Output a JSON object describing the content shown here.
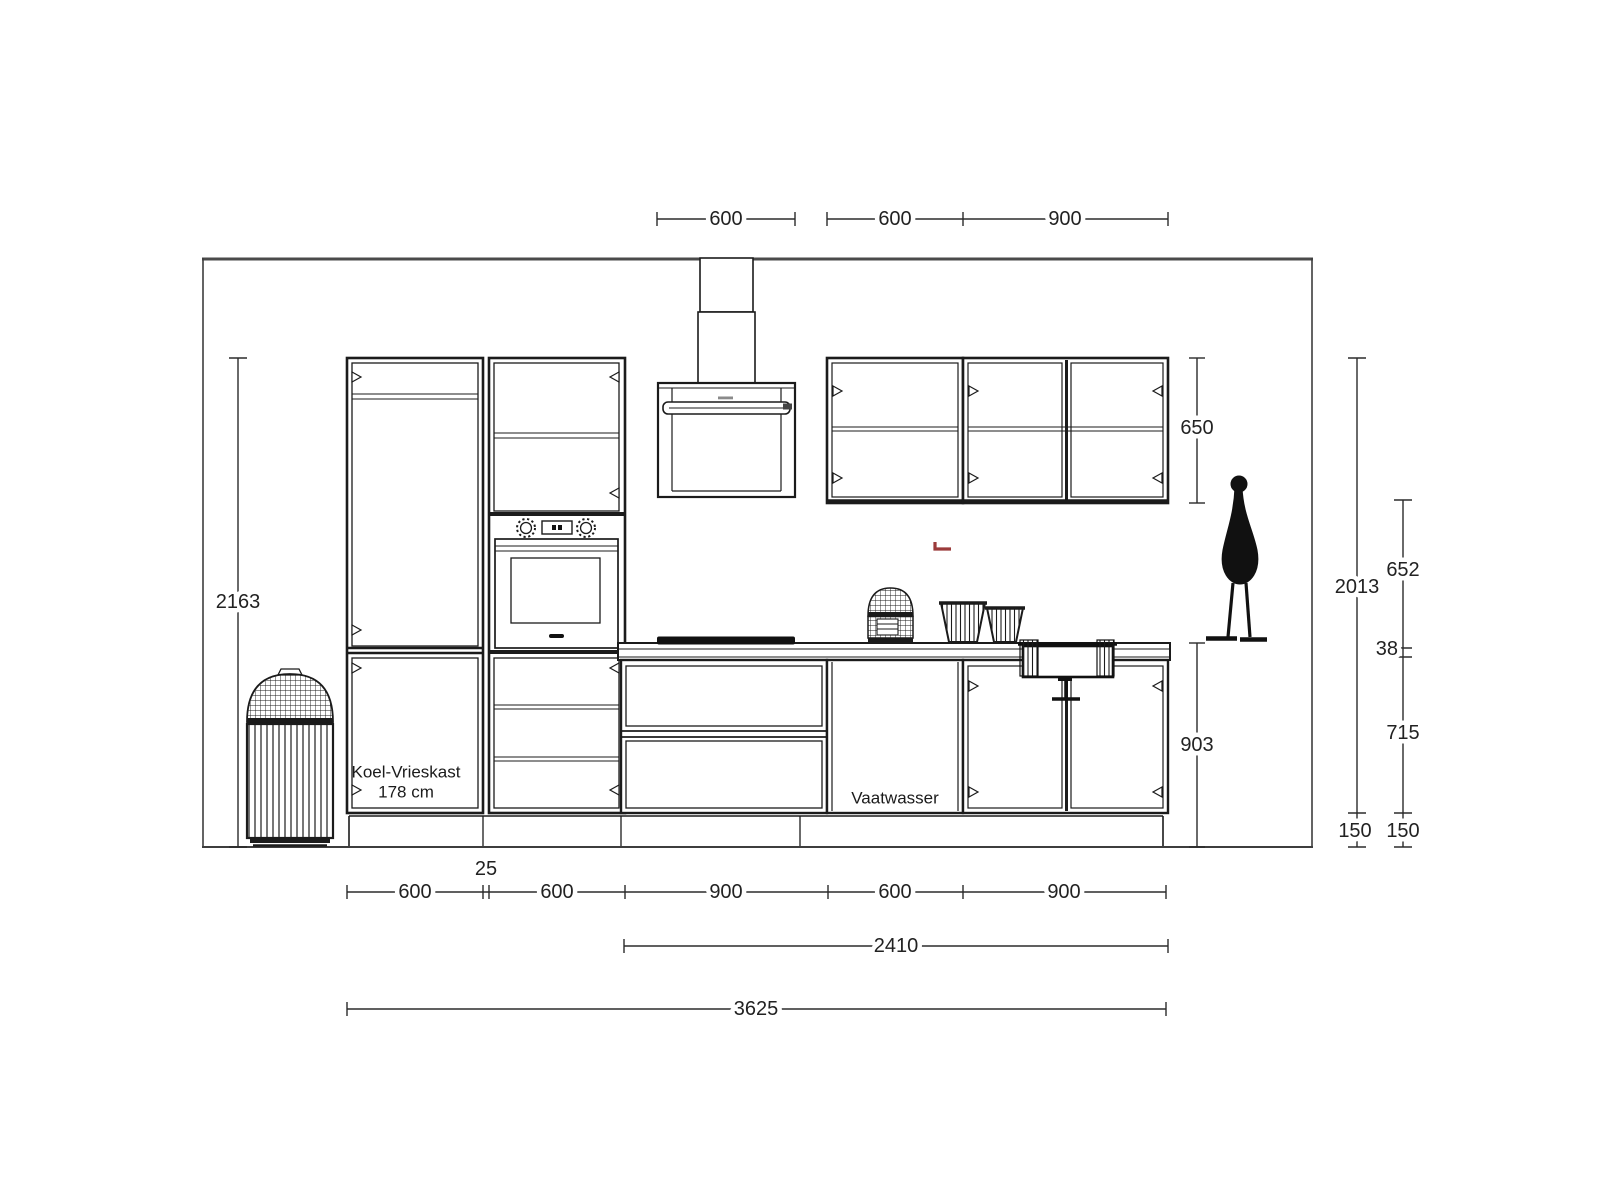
{
  "drawing": {
    "type_label": "kitchen-elevation",
    "annotations": {
      "fridge_line1": "Koel-Vrieskast",
      "fridge_line2": "178 cm",
      "dishwasher_label": "Vaatwasser"
    },
    "dimensions": {
      "top": {
        "hood_width": "600",
        "wall_cabinet_small": "600",
        "wall_cabinet_large": "900"
      },
      "left": {
        "total_height": "2163"
      },
      "right": {
        "wall_cabinet_height": "650",
        "upper_run_height": "2013",
        "splashback_height": "652",
        "worktop_thickness": "38",
        "base_front_height": "715",
        "plinth_height_a": "150",
        "plinth_height_b": "150",
        "base_total_height": "903"
      },
      "bottom": {
        "fridge_width": "600",
        "filler_width": "25",
        "oven_width": "600",
        "drawer_unit_width": "900",
        "dishwasher_width": "600",
        "sink_unit_width": "900",
        "appliance_run": "2410",
        "total_width": "3625"
      }
    },
    "colors": {
      "line": "#1b1b1b",
      "outline": "#454545",
      "dimension": "#2b2b2b",
      "accent_red": "#9b3a3a",
      "background": "#ffffff"
    }
  }
}
